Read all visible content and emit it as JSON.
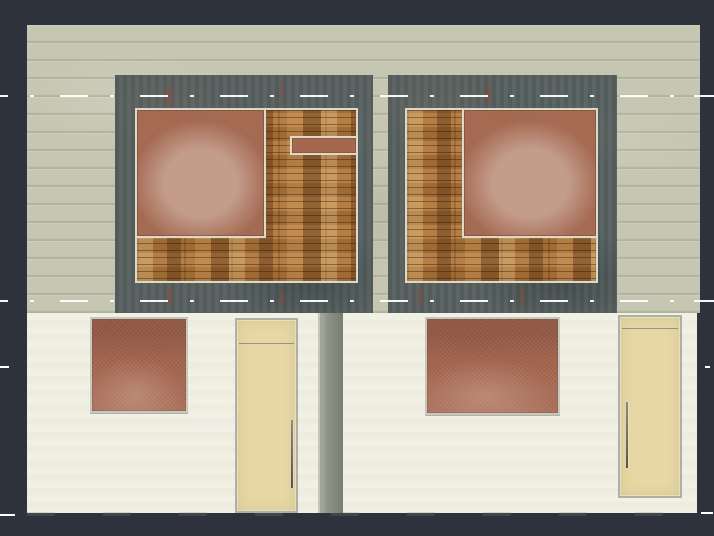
{
  "scene": {
    "type": "architectural-elevation-render",
    "description": "Front elevation rendering of a semi-detached house shown on a dark CAD viewport background: beige siding upper storey with two slate gable panels clad in wood, each holding a large terracotta masonry square (left panel also has a small transom opening), above a cream ground-floor wall with two terracotta brick windows, two tan entry doors with vertical pull handles, and a gray downpipe; white dash-dot level lines cross the elevation at two heights with shorter level ticks at the wall edges",
    "visible_text": "none",
    "units": [
      {
        "side": "left",
        "gable_square": "top-left of wood cladding",
        "has_transom_opening": true,
        "door_handle_side": "right"
      },
      {
        "side": "right",
        "gable_square": "top-right of wood cladding",
        "has_transom_opening": false,
        "door_handle_side": "left"
      }
    ],
    "level_lines": {
      "style": "dash-dot",
      "full_width_count": 2,
      "edge_tick_rows": 2
    }
  },
  "palette": {
    "viewport_background": "#2d323d",
    "siding": "#c6c7b2",
    "panel_slate": "#56605f",
    "trim": "#dcd9ca",
    "wood": "#b1773b",
    "terracotta": "#a5684f",
    "terracotta_highlight": "#c49c8b",
    "lower_wall": "#f0efe2",
    "window_brick": "#a2634c",
    "window_frame": "#c6c8bf",
    "door": "#e6d7a4",
    "door_frame": "#adb0a4",
    "downpipe": "#8f9388",
    "dash_line": "#ffffff",
    "handle": "#55574d"
  },
  "components": {
    "viewport": {
      "label": "CAD viewport canvas"
    },
    "upper_wall": {
      "label": "Beige siding upper wall"
    },
    "panel_left": {
      "label": "Left slate gable panel"
    },
    "panel_right": {
      "label": "Right slate gable panel"
    },
    "wood_left": {
      "label": "Left wood cladding inset"
    },
    "wood_right": {
      "label": "Right wood cladding inset"
    },
    "square_left": {
      "label": "Left terracotta masonry square"
    },
    "square_right": {
      "label": "Right terracotta masonry square"
    },
    "transom": {
      "label": "Small transom opening"
    },
    "lower_wall": {
      "label": "Cream ground-floor wall"
    },
    "window_left": {
      "label": "Left brick window"
    },
    "window_right": {
      "label": "Right brick window"
    },
    "door_left": {
      "label": "Left entry door"
    },
    "door_right": {
      "label": "Right entry door"
    },
    "downpipe": {
      "label": "Gray downpipe"
    },
    "dash_upper": {
      "label": "Upper dash-dot level line"
    },
    "dash_lower": {
      "label": "Lower dash-dot level line"
    },
    "tick": {
      "label": "Level line edge tick"
    }
  }
}
